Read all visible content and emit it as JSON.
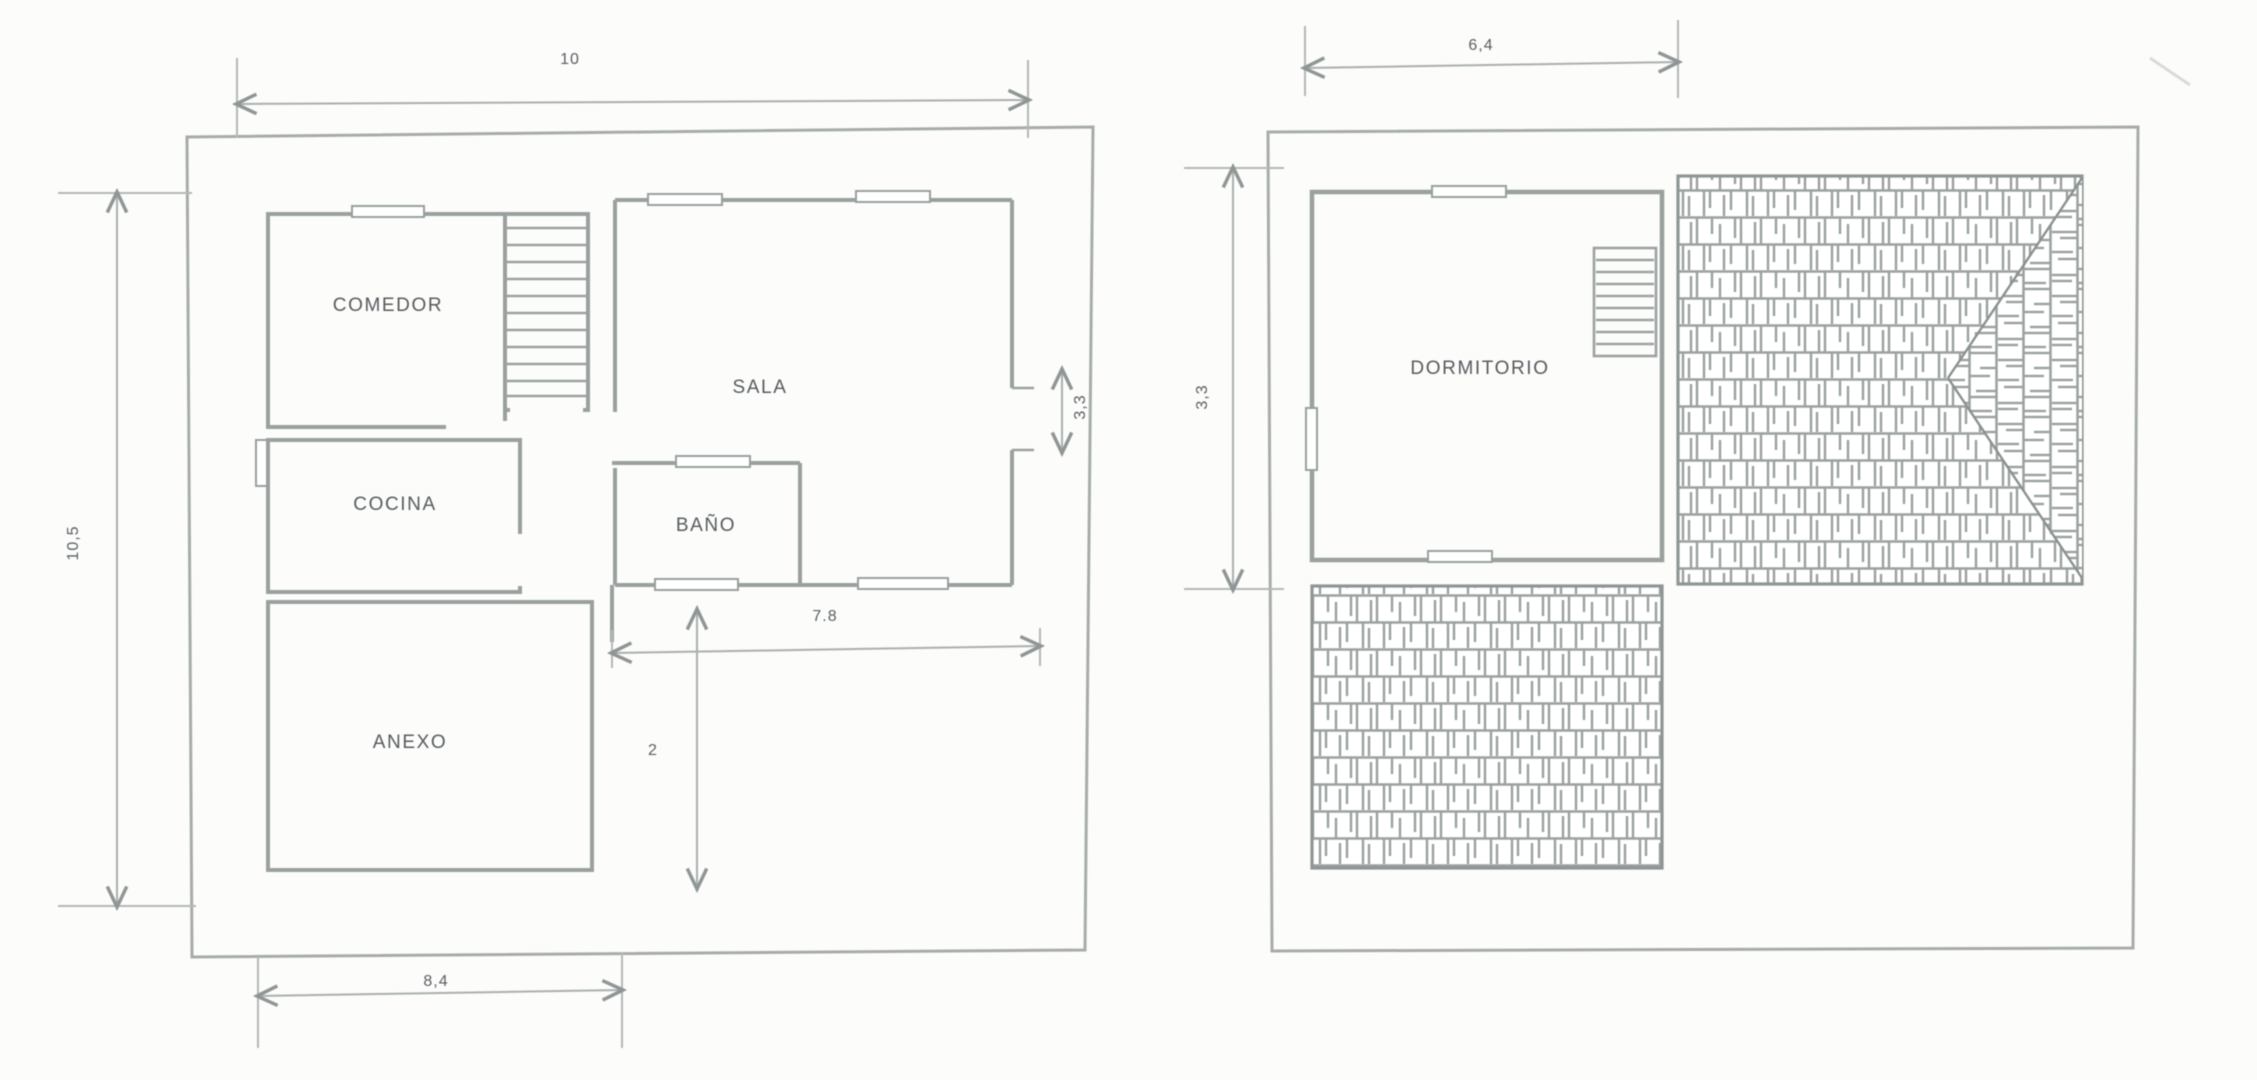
{
  "palette": {
    "background": "#fcfcfb",
    "wall_line": "#99a09e",
    "dimension_line": "#a9b0ae",
    "text": "#565b5d"
  },
  "ground_floor": {
    "rooms": {
      "comedor": "COMEDOR",
      "cocina": "COCINA",
      "sala": "SALA",
      "bano": "BAÑO",
      "anexo": "ANEXO"
    },
    "dims": {
      "top_width": "10",
      "left_height": "10,5",
      "bottom_width": "8,4",
      "interior_width": "7.8",
      "interior_height": "2",
      "right_opening": "3,3"
    }
  },
  "upper_floor": {
    "rooms": {
      "dormitorio": "DORMITORIO"
    },
    "dims": {
      "top_width": "6,4",
      "left_height": "3,3"
    }
  }
}
